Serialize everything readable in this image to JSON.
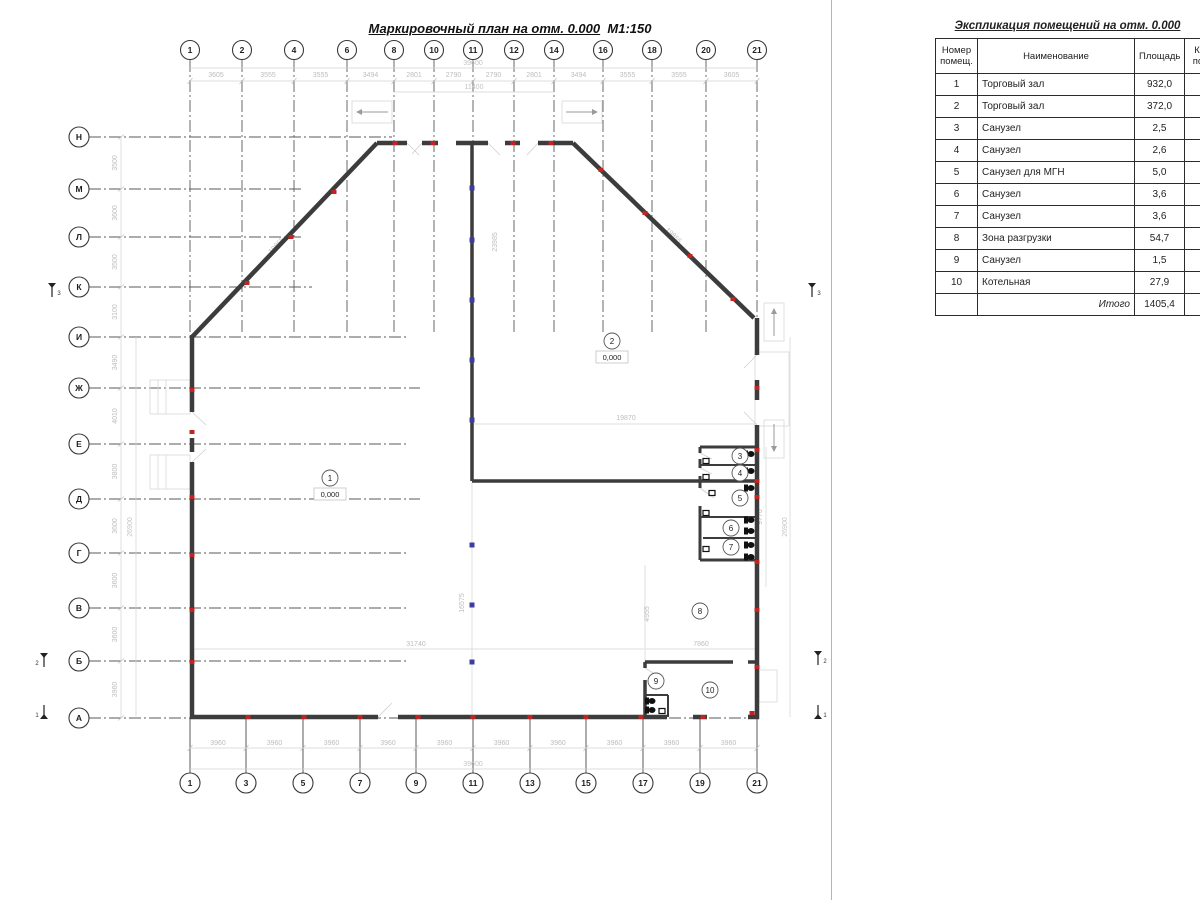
{
  "plan": {
    "title": "Маркировочный план на отм. 0.000",
    "scale": "М1:150"
  },
  "explication": {
    "title": "Экспликация помещений на отм. 0.000",
    "col_number": "Номер\nпомещ.",
    "col_name": "Наименование",
    "col_area": "Площадь",
    "col_category": "Кат.\nпом.",
    "rows": [
      {
        "num": "1",
        "name": "Торговый зал",
        "area": "932,0"
      },
      {
        "num": "2",
        "name": "Торговый зал",
        "area": "372,0"
      },
      {
        "num": "3",
        "name": "Санузел",
        "area": "2,5"
      },
      {
        "num": "4",
        "name": "Санузел",
        "area": "2,6"
      },
      {
        "num": "5",
        "name": "Санузел для МГН",
        "area": "5,0"
      },
      {
        "num": "6",
        "name": "Санузел",
        "area": "3,6"
      },
      {
        "num": "7",
        "name": "Санузел",
        "area": "3,6"
      },
      {
        "num": "8",
        "name": "Зона разгрузки",
        "area": "54,7"
      },
      {
        "num": "9",
        "name": "Санузел",
        "area": "1,5"
      },
      {
        "num": "10",
        "name": "Котельная",
        "area": "27,9"
      }
    ],
    "total_label": "Итого",
    "total_value": "1405,4"
  },
  "axes": {
    "top_labels": [
      "1",
      "2",
      "4",
      "6",
      "8",
      "10",
      "11",
      "12",
      "14",
      "16",
      "18",
      "20",
      "21"
    ],
    "bottom_labels": [
      "1",
      "3",
      "5",
      "7",
      "9",
      "11",
      "13",
      "15",
      "17",
      "19",
      "21"
    ],
    "row_labels": [
      "Н",
      "М",
      "Л",
      "К",
      "И",
      "Ж",
      "Е",
      "Д",
      "Г",
      "В",
      "Б",
      "А"
    ]
  },
  "dims": {
    "top_segments": [
      "3605",
      "3555",
      "3555",
      "3494",
      "2801",
      "2790",
      "2790",
      "2801",
      "3494",
      "3555",
      "3555",
      "3605"
    ],
    "top_total": "39600",
    "top_inner": "11400",
    "bottom_segments": [
      "3960",
      "3960",
      "3960",
      "3960",
      "3960",
      "3960",
      "3960",
      "3960",
      "3960",
      "3960"
    ],
    "bottom_total": "39600",
    "left_segments": [
      "3500",
      "3600",
      "3500",
      "3100",
      "3490",
      "4010",
      "3800",
      "3600",
      "3600",
      "3600",
      "3960"
    ],
    "left_total": "26900",
    "right_total": "26900",
    "right_inner": "9770",
    "diag_left": "19855",
    "diag_right": "19855",
    "mid_wall": "23985",
    "hall_width": "31740",
    "hall_height": "16575",
    "room2_width": "19870",
    "zone8_width": "7860",
    "zone8_height": "4955"
  },
  "rooms": [
    {
      "num": "1",
      "elevation": "0,000"
    },
    {
      "num": "2",
      "elevation": "0,000"
    },
    {
      "num": "3"
    },
    {
      "num": "4"
    },
    {
      "num": "5"
    },
    {
      "num": "6"
    },
    {
      "num": "7"
    },
    {
      "num": "8"
    },
    {
      "num": "9"
    },
    {
      "num": "10"
    }
  ],
  "section_marks": [
    "3",
    "3",
    "2",
    "2",
    "1",
    "1"
  ],
  "colors": {
    "wall": "#3c3c3c",
    "marker_red": "#c52222",
    "marker_blue": "#3d3da0",
    "axis_line": "#5a5a5a",
    "dim_line": "#d2d2d2",
    "faint": "#d8d8d8"
  }
}
